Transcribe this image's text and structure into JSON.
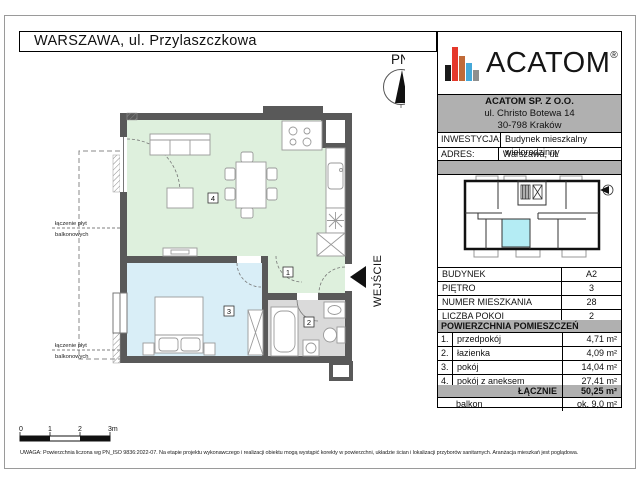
{
  "page": {
    "title": "WARSZAWA, ul. Przylaszczkowa"
  },
  "logo": {
    "brand": "ACATOM",
    "reg": "®"
  },
  "company": {
    "name": "ACATOM SP. Z O.O.",
    "street": "ul. Christo Botewa 14",
    "city": "30-798 Kraków"
  },
  "project": {
    "inwestycja_label": "INWESTYCJA:",
    "inwestycja_value": "Budynek mieszkalny wielorodzinny",
    "adres_label": "ADRES:",
    "adres_value": "Warszawa, ul. Przylaszczkowa"
  },
  "unit_info": {
    "rows": [
      {
        "label": "BUDYNEK",
        "value": "A2"
      },
      {
        "label": "PIĘTRO",
        "value": "3"
      },
      {
        "label": "NUMER MIESZKANIA",
        "value": "28"
      },
      {
        "label": "LICZBA POKOI",
        "value": "2"
      }
    ]
  },
  "areas": {
    "header": "POWIERZCHNIA POMIESZCZEŃ",
    "rooms": [
      {
        "no": "1.",
        "name": "przedpokój",
        "area": "4,71 m²"
      },
      {
        "no": "2.",
        "name": "łazienka",
        "area": "4,09 m²"
      },
      {
        "no": "3.",
        "name": "pokój",
        "area": "14,04 m²"
      },
      {
        "no": "4.",
        "name": "pokój z aneksem kuchennym",
        "area": "27,41 m²"
      }
    ],
    "total_label": "ŁĄCZNIE",
    "total_value": "50,25 m²",
    "balcony_label": "balkon",
    "balcony_value": "ok. 9,0 m²"
  },
  "plan": {
    "compass_label": "PN",
    "entrance_label": "WEJŚCIE",
    "room_labels": {
      "hall": "1",
      "bath": "2",
      "bedroom": "3",
      "living": "4"
    },
    "balcony_note_line1": "łączenie płyt",
    "balcony_note_line2": "balkonowych"
  },
  "scale": {
    "t0": "0",
    "t1": "1",
    "t2": "2",
    "t3": "3m"
  },
  "footer": {
    "note": "UWAGA: Powierzchnia liczona wg PN_ISO 9836:2022-07. Na etapie projektu wykonawczego i realizacji obiektu mogą wystąpić korekty w powierzchni, układzie ścian i lokalizacji przyborów sanitarnych. Aranżacja mieszkań jest poglądowa."
  },
  "colors": {
    "wall": "#595959",
    "living_room": "#def0dd",
    "bedroom": "#d9eef7",
    "bathroom": "#dadada",
    "keyplan_highlight": "#b4ecf4",
    "panel_band": "#b0b0b0",
    "logo_black": "#1a1a1a",
    "logo_red": "#e5382b",
    "logo_orange": "#c06a38",
    "logo_blue": "#45a8d8",
    "logo_gray": "#8f8f8f"
  }
}
